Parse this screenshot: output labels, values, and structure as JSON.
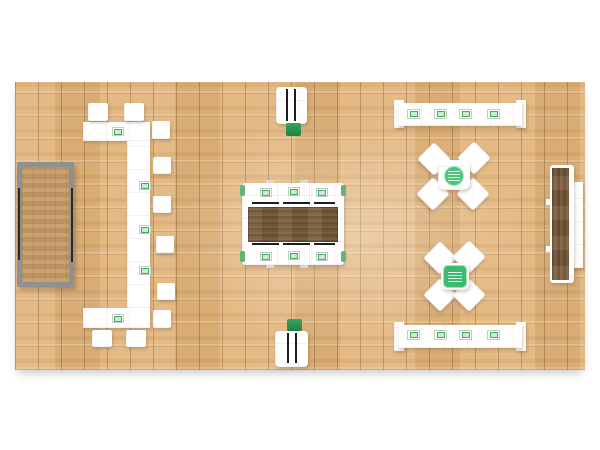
{
  "scene": {
    "title": "Trade show booth floor plan – rendered top view",
    "floor": {
      "name": "hardwood-plank-floor",
      "tile_grid": true,
      "base_color": "#e3b67e",
      "grid_line_color": "#8a6a48"
    },
    "palette": {
      "white_furniture": "#ffffff",
      "accent_green": "#2fa558",
      "accent_green_bright": "#4cc47d",
      "badge_border_green": "#3fae5c",
      "badge_fill_green": "#cdeccd",
      "walnut_wood": "#7a5b3b",
      "oak_wood": "#c59a66",
      "gray_frame": "#8f8f8f",
      "line_black": "#1c1c1c"
    },
    "items": [
      {
        "name": "left-wood-table",
        "label": "Rectangular oak-top table with gray frame and side rails"
      },
      {
        "name": "left-bar-counter",
        "label": "C-shaped white bar counter with logo plaques",
        "stools": 10,
        "logo_plaques": 5
      },
      {
        "name": "top-display-kiosk",
        "label": "White display kiosk with green base"
      },
      {
        "name": "bottom-display-kiosk",
        "label": "White display kiosk with green base"
      },
      {
        "name": "center-meeting-table",
        "label": "Walnut conference table with six white logo chairs",
        "chairs": 6,
        "logo_plaques": 6
      },
      {
        "name": "upper-x-seating",
        "label": "X-shaped four-seat cluster with round green logo table",
        "chairs": 4
      },
      {
        "name": "lower-x-seating",
        "label": "X-shaped four-seat cluster with square green logo table",
        "chairs": 4
      },
      {
        "name": "upper-right-counter",
        "label": "White reception counter with end caps",
        "logo_plaques": 4
      },
      {
        "name": "lower-right-counter",
        "label": "White reception counter with end caps",
        "logo_plaques": 4
      },
      {
        "name": "right-wood-counter",
        "label": "Walnut-top bar counter with white bench ledge"
      }
    ]
  }
}
